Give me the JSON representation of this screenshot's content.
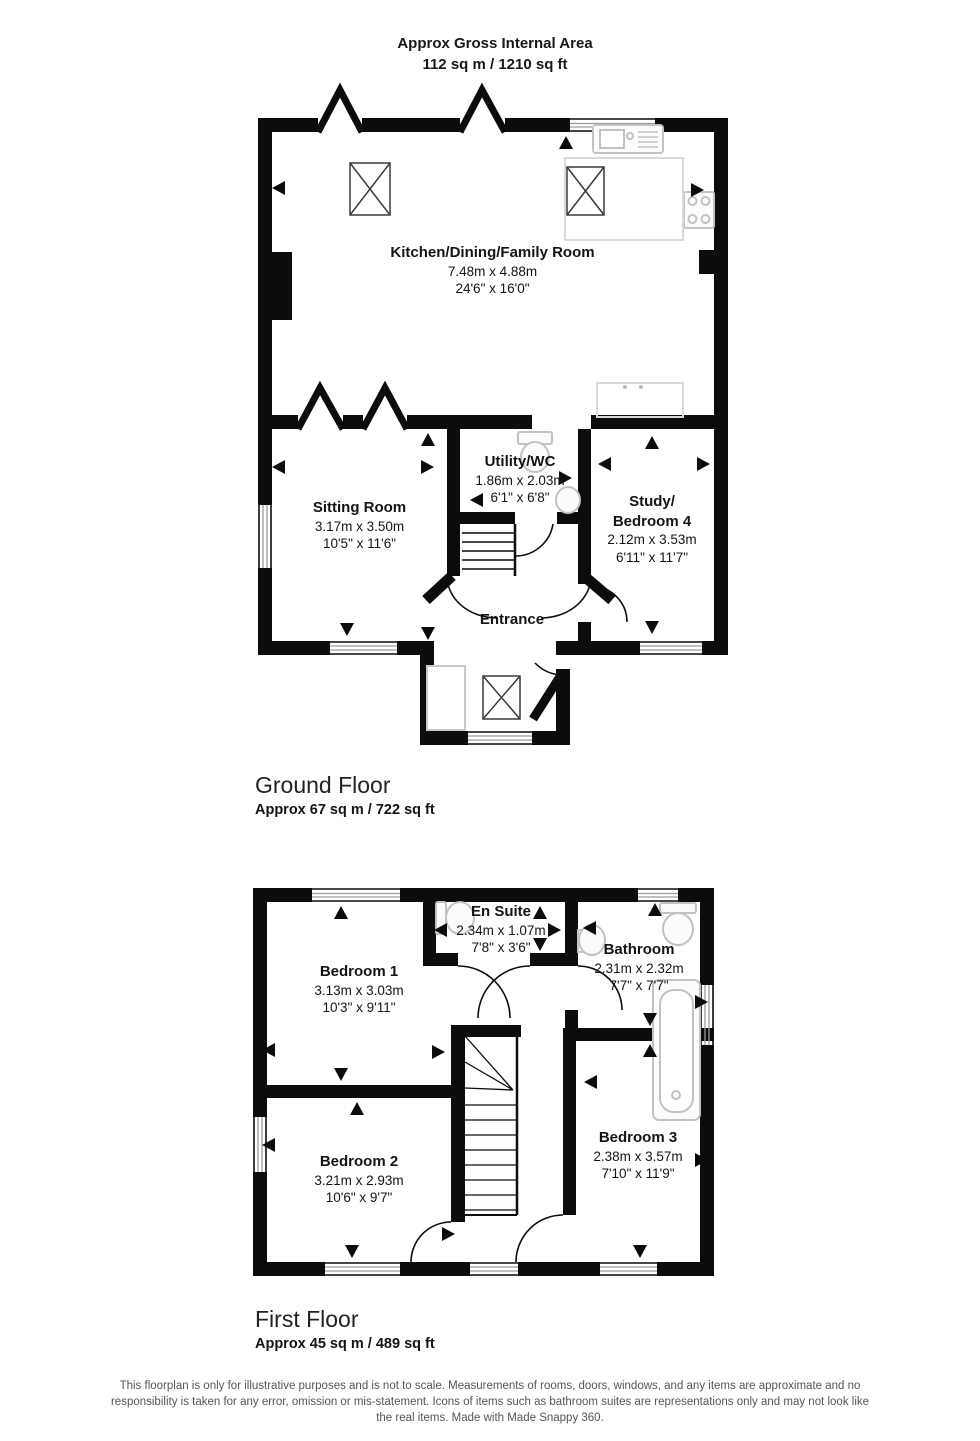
{
  "header": {
    "title_line1": "Approx Gross Internal Area",
    "title_line2": "112 sq m / 1210 sq ft"
  },
  "ground_floor": {
    "heading": "Ground Floor",
    "area": "Approx 67 sq m / 722 sq ft",
    "rooms": {
      "kitchen": {
        "name": "Kitchen/Dining/Family Room",
        "metric": "7.48m x 4.88m",
        "imperial": "24'6\" x 16'0\""
      },
      "sitting": {
        "name": "Sitting Room",
        "metric": "3.17m x 3.50m",
        "imperial": "10'5\" x 11'6\""
      },
      "utility": {
        "name": "Utility/WC",
        "metric": "1.86m x 2.03m",
        "imperial": "6'1\" x 6'8\""
      },
      "study": {
        "name": "Study/",
        "name2": "Bedroom 4",
        "metric": "2.12m x 3.53m",
        "imperial": "6'11\" x 11'7\""
      },
      "entrance": {
        "name": "Entrance"
      }
    }
  },
  "first_floor": {
    "heading": "First Floor",
    "area": "Approx 45 sq m / 489 sq ft",
    "rooms": {
      "ensuite": {
        "name": "En Suite",
        "metric": "2.34m x 1.07m",
        "imperial": "7'8\" x 3'6\""
      },
      "bathroom": {
        "name": "Bathroom",
        "metric": "2.31m x 2.32m",
        "imperial": "7'7\" x 7'7\""
      },
      "bedroom1": {
        "name": "Bedroom 1",
        "metric": "3.13m x 3.03m",
        "imperial": "10'3\" x 9'11\""
      },
      "bedroom2": {
        "name": "Bedroom 2",
        "metric": "3.21m x 2.93m",
        "imperial": "10'6\" x 9'7\""
      },
      "bedroom3": {
        "name": "Bedroom 3",
        "metric": "2.38m x 3.57m",
        "imperial": "7'10\" x 11'9\""
      }
    }
  },
  "footer": {
    "disclaimer": "This floorplan is only for illustrative purposes and is not to scale. Measurements of rooms, doors, windows, and any items are approximate and no responsibility is taken for any error, omission or mis-statement. Icons of items such as bathroom suites are representations only and may not look like the real items. Made with Made Snappy 360."
  }
}
